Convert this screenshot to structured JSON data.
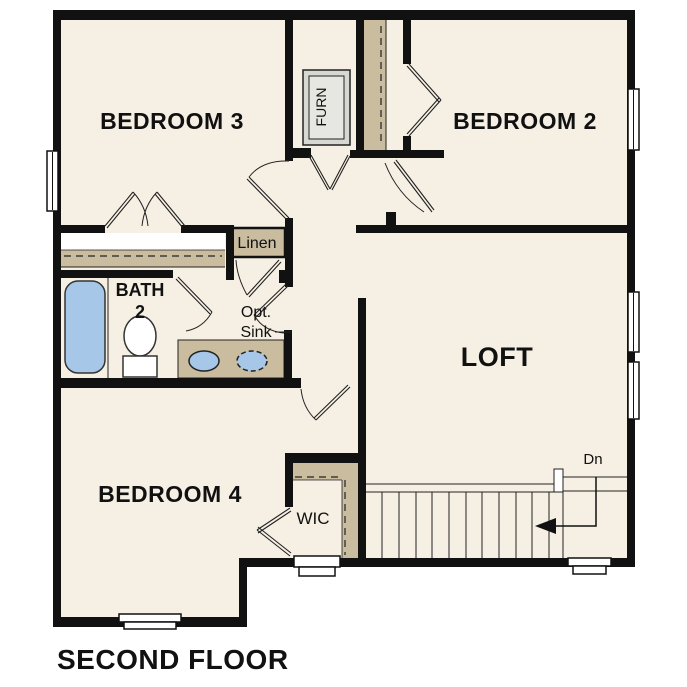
{
  "plan": {
    "title": "SECOND FLOOR"
  },
  "rooms": {
    "bedroom3": "BEDROOM 3",
    "bedroom2": "BEDROOM 2",
    "bedroom4": "BEDROOM 4",
    "loft": "LOFT",
    "bath_line1": "BATH",
    "bath_line2": "2",
    "wic": "WIC",
    "linen": "Linen",
    "furnace": "FURN"
  },
  "annotations": {
    "optional_sink_line1": "Opt.",
    "optional_sink_line2": "Sink",
    "stair_direction": "Dn"
  },
  "colors": {
    "wall": "#111111",
    "floor": "#f6efe3",
    "closet": "#c9bc9f",
    "fixture": "#a6c7e7",
    "furn": "#d8d8d2",
    "furn-inner": "#e7e7e2",
    "line": "#222222",
    "text": "#111111"
  }
}
